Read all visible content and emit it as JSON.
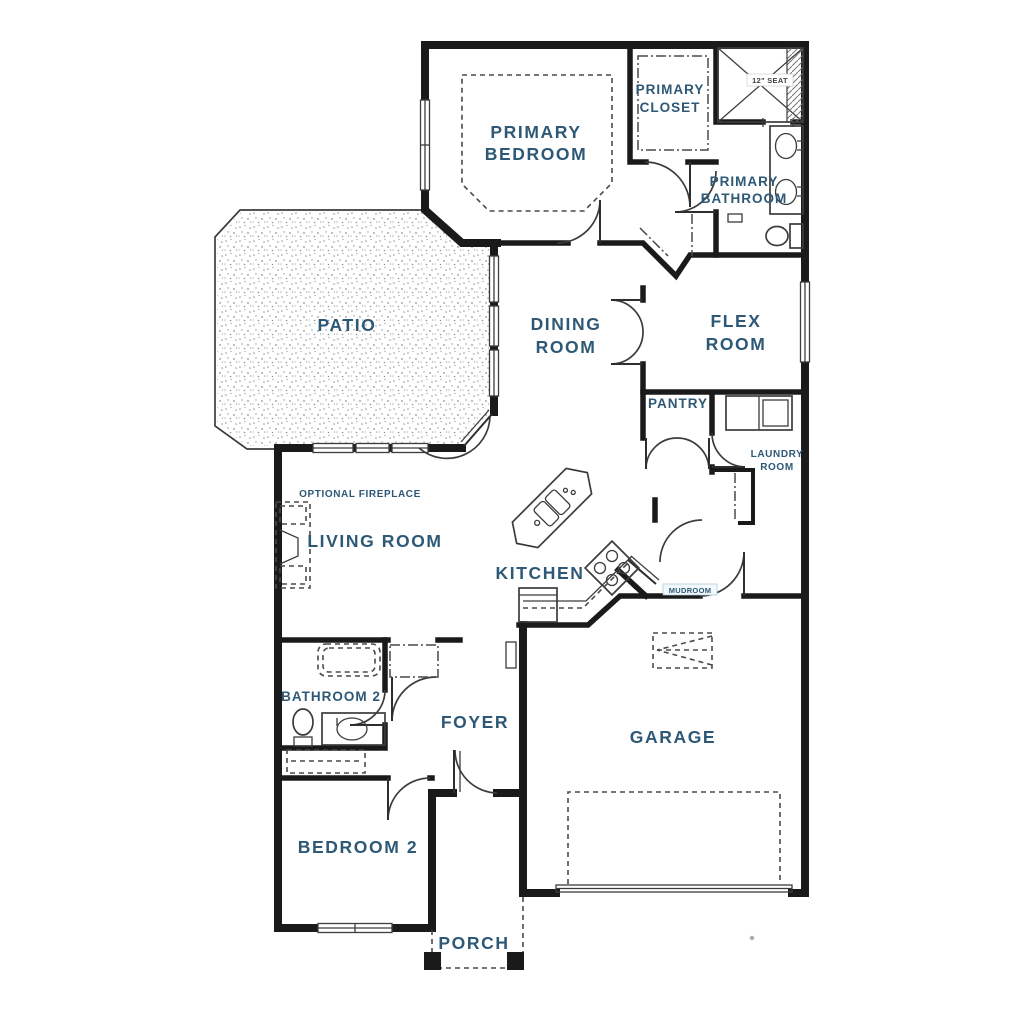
{
  "page": {
    "background": "#ffffff"
  },
  "colors": {
    "wall": "#1a1a1a",
    "line": "#3c3c3c",
    "label": "#2d5876",
    "stipple": "#8d949c",
    "seat_text": "#444444"
  },
  "labels": {
    "primary_bedroom_1": "PRIMARY",
    "primary_bedroom_2": "BEDROOM",
    "primary_closet_1": "PRIMARY",
    "primary_closet_2": "CLOSET",
    "primary_bathroom_1": "PRIMARY",
    "primary_bathroom_2": "BATHROOM",
    "shower_seat": "12\" SEAT",
    "patio": "PATIO",
    "dining_1": "DINING",
    "dining_2": "ROOM",
    "flex_1": "FLEX",
    "flex_2": "ROOM",
    "pantry": "PANTRY",
    "laundry_1": "LAUNDRY",
    "laundry_2": "ROOM",
    "optional_fireplace": "OPTIONAL FIREPLACE",
    "living_room": "LIVING ROOM",
    "kitchen": "KITCHEN",
    "mudroom": "MUDROOM",
    "bathroom_2": "BATHROOM 2",
    "foyer": "FOYER",
    "garage": "GARAGE",
    "bedroom_2": "BEDROOM 2",
    "porch": "PORCH"
  },
  "fixture_names": [
    "shower-with-seat",
    "double-sink-vanity",
    "toilet",
    "bathtub",
    "washer-dryer",
    "kitchen-island-sink",
    "range-cooktop",
    "refrigerator",
    "optional-fireplace",
    "attic-access",
    "garage-door",
    "porch-columns",
    "closet-rod",
    "linen-closet"
  ]
}
